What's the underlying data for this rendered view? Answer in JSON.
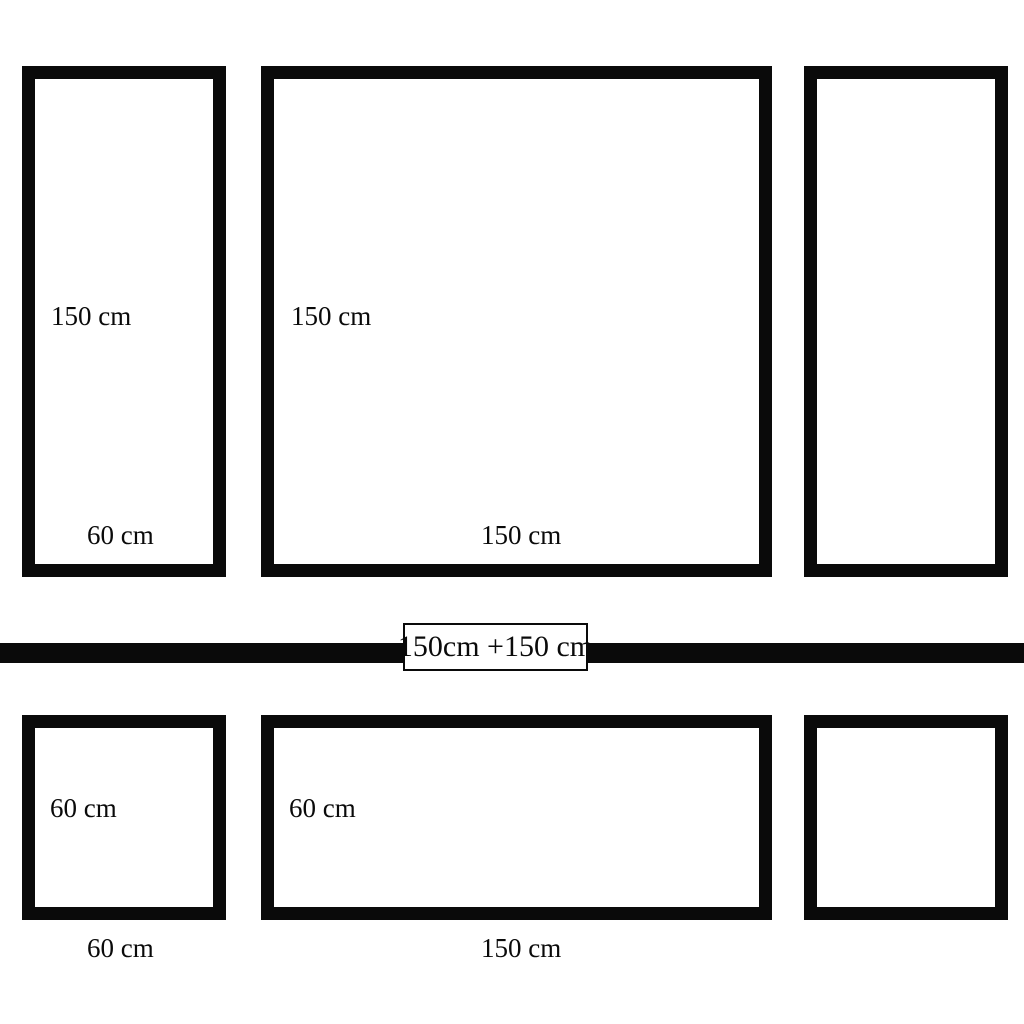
{
  "page": {
    "background_color": "#ffffff",
    "ink_color": "#0a0a0a",
    "description": "Picture frame set dimension diagram: two wall rows separated by a rail bar"
  },
  "top_row": {
    "frames": [
      {
        "id": "tall-left",
        "height_label": "150 cm",
        "width_label": "60 cm",
        "width_cm": 60,
        "height_cm": 150
      },
      {
        "id": "large-square",
        "height_label": "150 cm",
        "width_label": "150 cm",
        "width_cm": 150,
        "height_cm": 150
      },
      {
        "id": "tall-right",
        "width_cm": 60,
        "height_cm": 150
      }
    ]
  },
  "divider": {
    "label": "150cm +150 cm"
  },
  "bottom_row": {
    "frames": [
      {
        "id": "small-square-left",
        "inside_label": "60 cm",
        "below_label": "60 cm",
        "width_cm": 60,
        "height_cm": 60
      },
      {
        "id": "wide",
        "inside_label": "60 cm",
        "below_label": "150 cm",
        "width_cm": 150,
        "height_cm": 60
      },
      {
        "id": "small-square-right",
        "width_cm": 60,
        "height_cm": 60
      }
    ]
  }
}
